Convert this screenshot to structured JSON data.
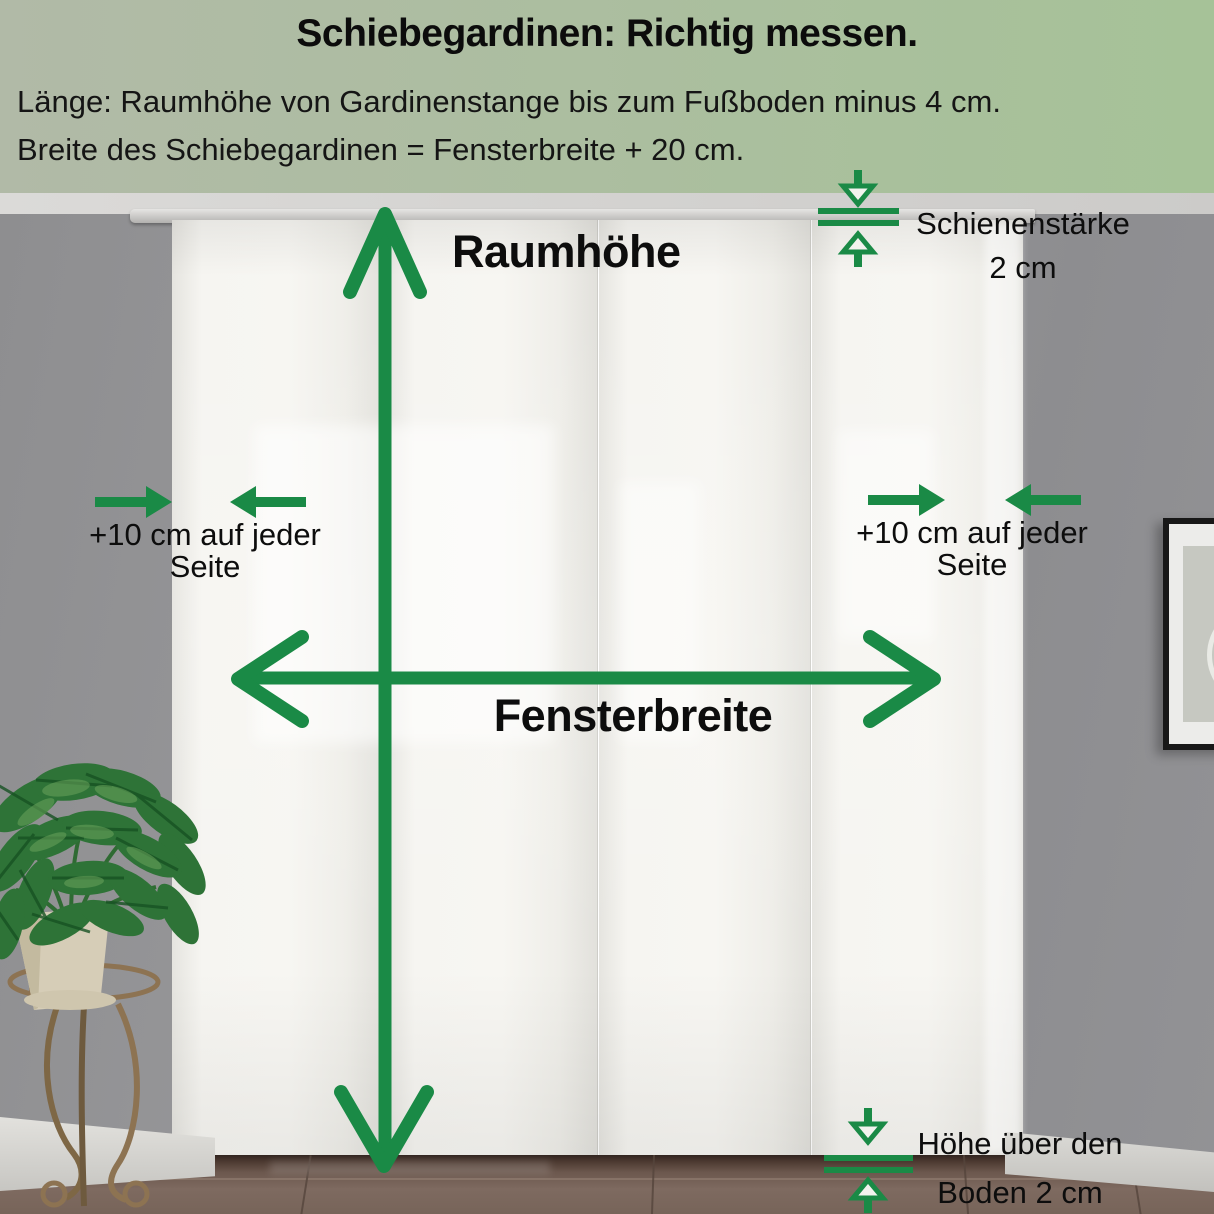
{
  "header": {
    "title": "Schiebegardinen: Richtig messen.",
    "instruction_line1": "Länge: Raumhöhe von Gardinenstange bis zum Fußboden minus 4 cm.",
    "instruction_line2": "Breite des Schiebegardinen = Fensterbreite + 20 cm."
  },
  "annotations": {
    "room_height_label": "Raumhöhe",
    "window_width_label": "Fensterbreite",
    "left_side": {
      "line1": "+10 cm auf jeder",
      "line2": "Seite"
    },
    "right_side": {
      "line1": "+10 cm auf jeder",
      "line2": "Seite"
    },
    "rail_thickness": {
      "line1": "Schienenstärke",
      "line2": "2 cm"
    },
    "floor_clearance": {
      "line1": "Höhe über den",
      "line2": "Boden 2 cm"
    }
  },
  "icons": {
    "room_height": "double-headed-vertical-arrow",
    "window_width": "double-headed-horizontal-arrow",
    "side_allowance": "converging-horizontal-arrows",
    "rail_thickness": "gap-measure-arrows",
    "floor_clearance": "gap-measure-arrows"
  },
  "colors": {
    "accent_green": "#1a8a46",
    "band_gradient_left": "#b1baa7",
    "band_gradient_right": "#a6c298",
    "text_black": "#111111",
    "curtain_white": "#f6f5f1",
    "wall_gray": "#96969a",
    "floor_brown": "#6b574d"
  }
}
